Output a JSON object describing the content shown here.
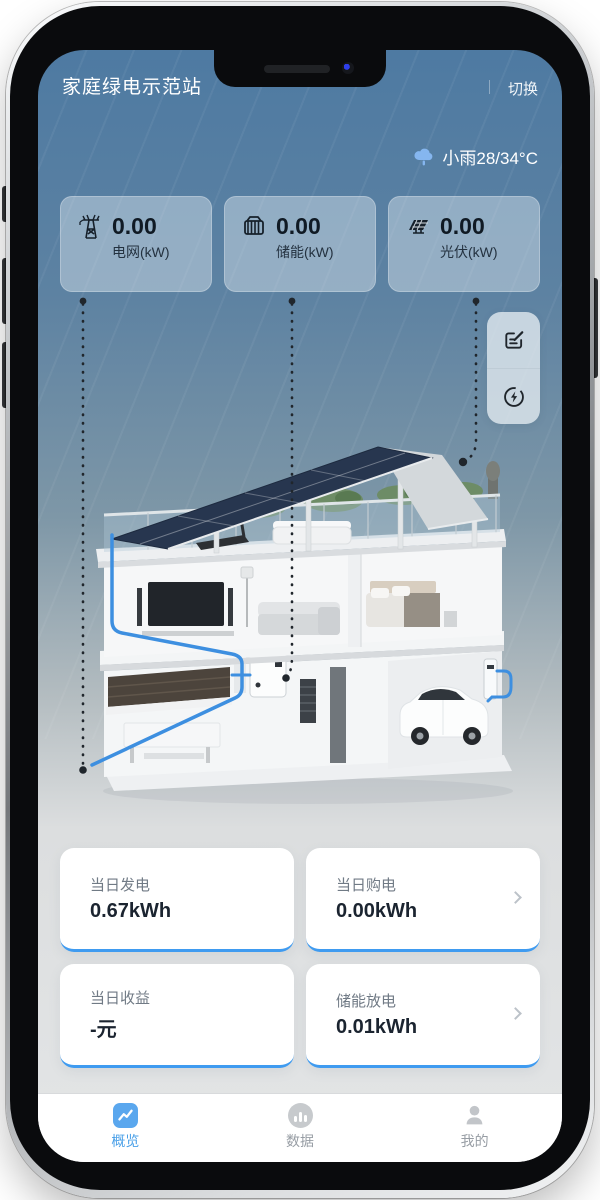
{
  "header": {
    "title": "家庭绿电示范站",
    "switch_label": "切换"
  },
  "weather": {
    "icon": "rain-cloud-icon",
    "text": "小雨28/34°C"
  },
  "stats": [
    {
      "icon": "power-tower-icon",
      "value": "0.00",
      "label": "电网(kW)"
    },
    {
      "icon": "battery-storage-icon",
      "value": "0.00",
      "label": "储能(kW)"
    },
    {
      "icon": "solar-panel-icon",
      "value": "0.00",
      "label": "光伏(kW)"
    }
  ],
  "fab": {
    "edit": "edit-icon",
    "energy": "energy-circle-icon"
  },
  "summary_cards": [
    {
      "label": "当日发电",
      "value": "0.67kWh",
      "has_chevron": false
    },
    {
      "label": "当日购电",
      "value": "0.00kWh",
      "has_chevron": true
    },
    {
      "label": "当日收益",
      "value": "-元",
      "has_chevron": false
    },
    {
      "label": "储能放电",
      "value": "0.01kWh",
      "has_chevron": true
    }
  ],
  "tabbar": [
    {
      "label": "概览",
      "active": true
    },
    {
      "label": "数据",
      "active": false
    },
    {
      "label": "我的",
      "active": false
    }
  ],
  "colors": {
    "accent": "#4aa0e8",
    "card_border": "#3f9bf0",
    "bg_top": "#4e7aa2",
    "bg_bottom": "#e3e5e6"
  }
}
